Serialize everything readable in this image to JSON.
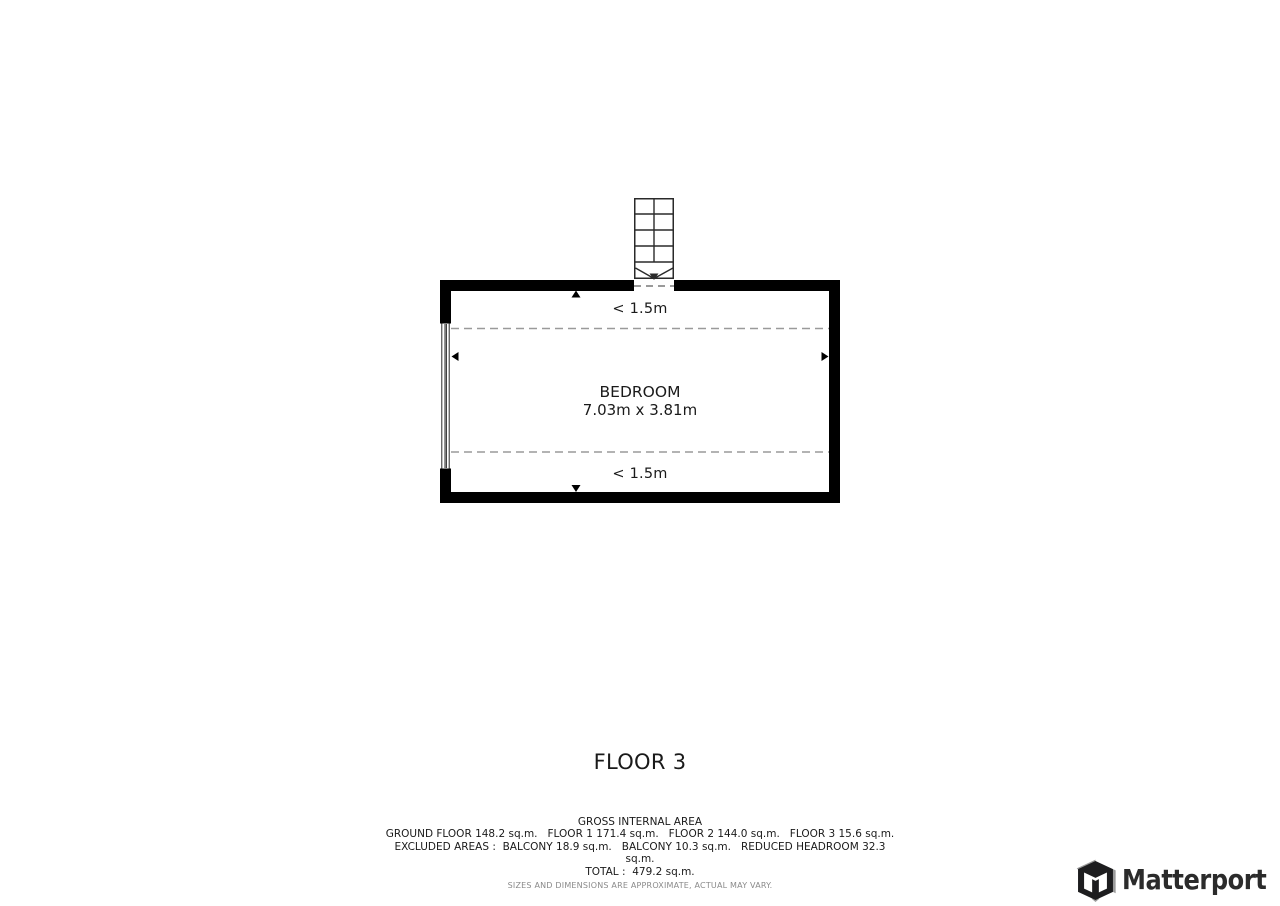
{
  "floor_plan": {
    "title": "FLOOR 3",
    "room": {
      "name": "BEDROOM",
      "dimensions": "7.03m x 3.81m",
      "headroom_top": "< 1.5m",
      "headroom_bottom": "< 1.5m"
    }
  },
  "footer": {
    "area_lines": [
      "GROSS INTERNAL AREA",
      "GROUND FLOOR 148.2 sq.m.   FLOOR 1 171.4 sq.m.   FLOOR 2 144.0 sq.m.   FLOOR 3 15.6 sq.m.",
      "EXCLUDED AREAS :  BALCONY 18.9 sq.m.   BALCONY 10.3 sq.m.   REDUCED HEADROOM 32.3",
      "sq.m.",
      "TOTAL :  479.2 sq.m."
    ],
    "disclaimer": "SIZES AND DIMENSIONS ARE APPROXIMATE, ACTUAL MAY VARY."
  },
  "branding": {
    "logo_text": "Matterport"
  },
  "colors": {
    "wall": "#000000",
    "stair_line": "#2a2a2a",
    "dashed_line": "#9a9a9a",
    "text": "#1a1a1a",
    "disclaimer_text": "#8a8a8a",
    "logo_text": "#2b2b2b"
  }
}
